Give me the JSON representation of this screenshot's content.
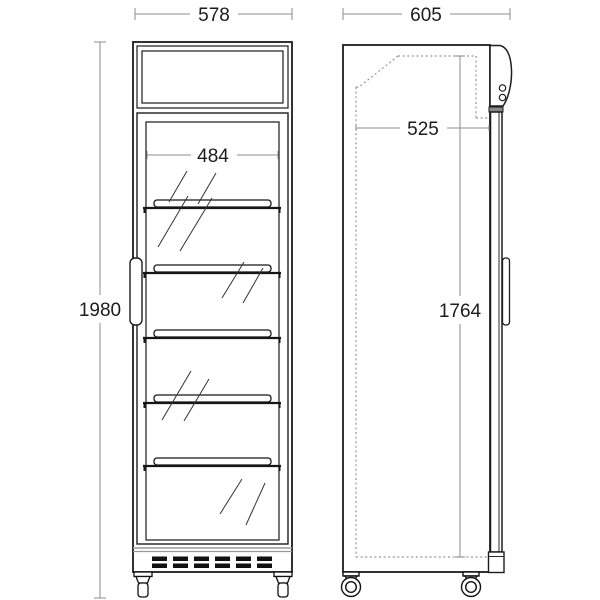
{
  "front_view": {
    "overall_width": "578",
    "overall_height": "1980",
    "internal_width": "484",
    "shelf_count": 5
  },
  "side_view": {
    "overall_depth": "605",
    "internal_depth": "525",
    "internal_height": "1764"
  },
  "colors": {
    "outline": "#1c1c1c",
    "dimension_line": "#8c8c8c",
    "hidden_line": "#989898",
    "panel_band": "#9a9a9a",
    "vent_dash": "#111111",
    "background": "#ffffff"
  }
}
